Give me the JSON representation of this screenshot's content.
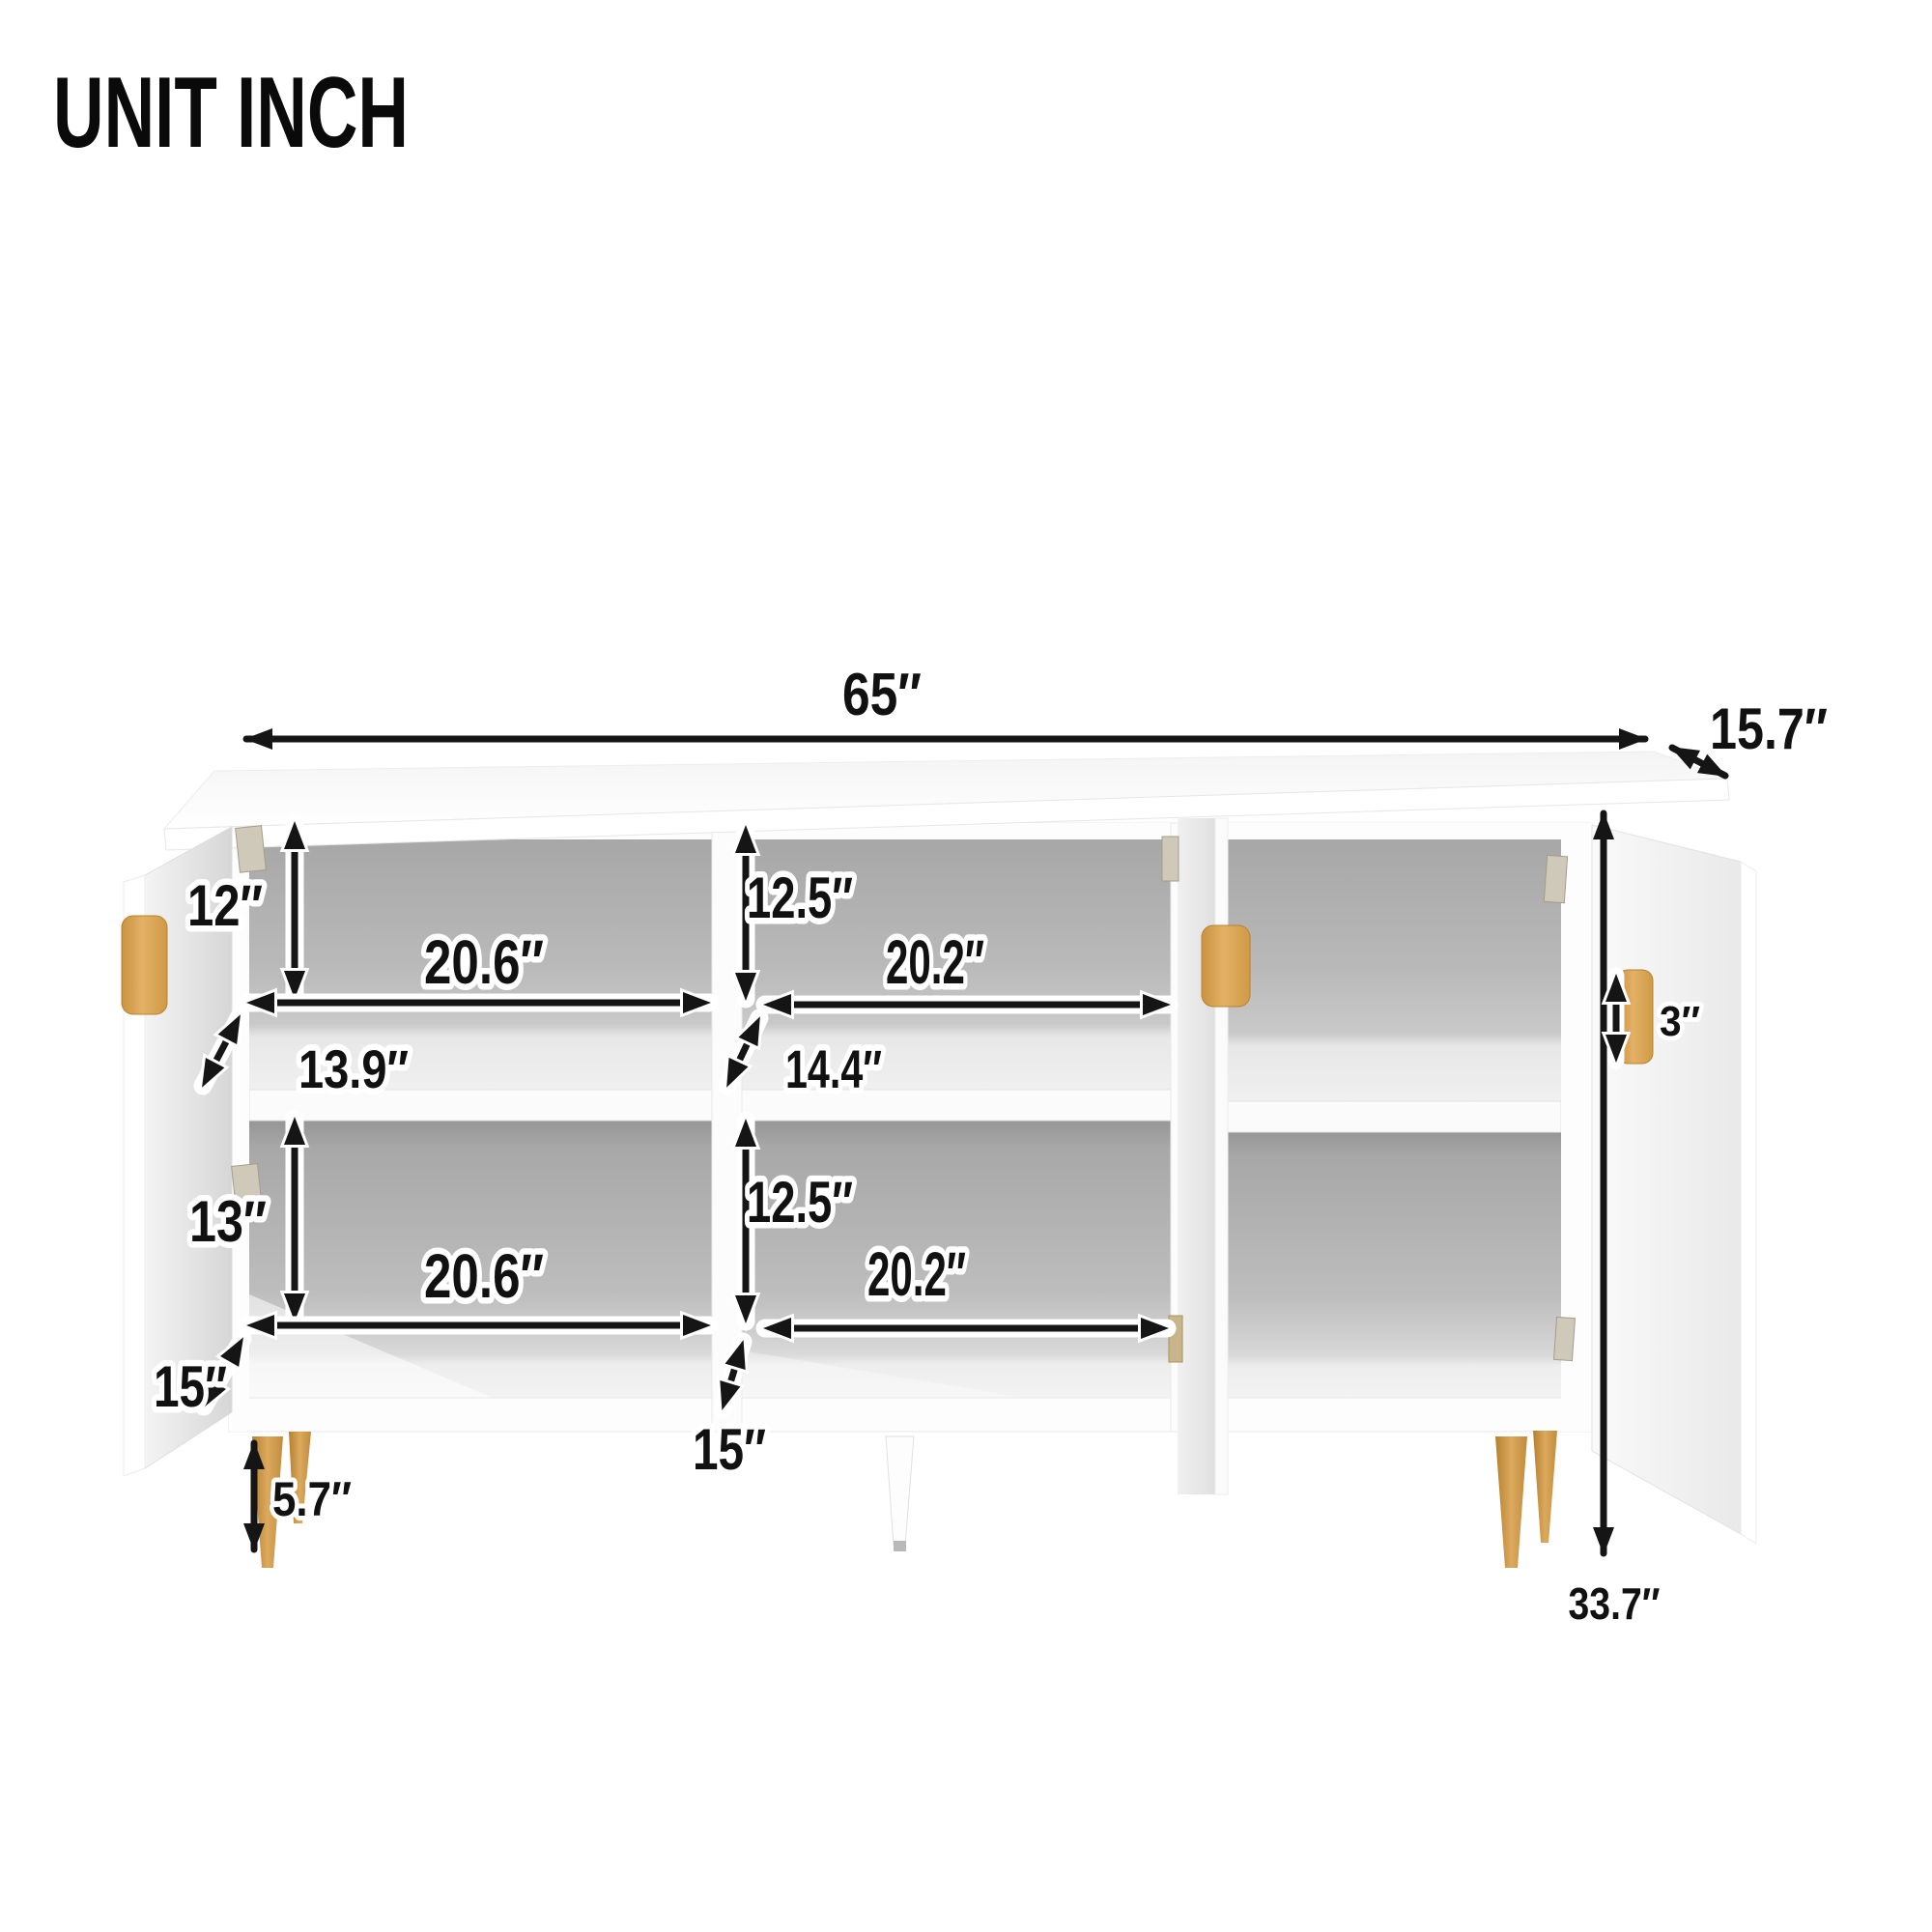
{
  "title": "UNIT INCH",
  "figure": {
    "type": "furniture-dimension-diagram",
    "item": "3-door sideboard cabinet shown with doors open",
    "unit": "inch"
  },
  "colors": {
    "background": "#FFFFFF",
    "cabinet_white": "#FCFCFC",
    "interior_gray": "#B5B5B5",
    "handle_and_leg_gold": "#D9A55F",
    "arrow_black": "#151515",
    "label_text": "#111111",
    "label_outline": "#FFFFFF"
  },
  "dimensions": {
    "overall_width": {
      "label": "65″"
    },
    "overall_depth": {
      "label": "15.7″"
    },
    "overall_height": {
      "label": "33.7″"
    },
    "leg_height": {
      "label": "5.7″"
    },
    "door_handle_height": {
      "label": "3″"
    },
    "left_upper_cell": {
      "height": "12″",
      "width": "20.6″",
      "depth": "13.9″"
    },
    "middle_upper_cell": {
      "height": "12.5″",
      "width": "20.2″",
      "depth": "14.4″"
    },
    "left_lower_cell": {
      "height": "13″",
      "width": "20.6″",
      "depth": "15″"
    },
    "middle_lower_cell": {
      "height": "12.5″",
      "width": "20.2″",
      "depth": "15″"
    }
  }
}
